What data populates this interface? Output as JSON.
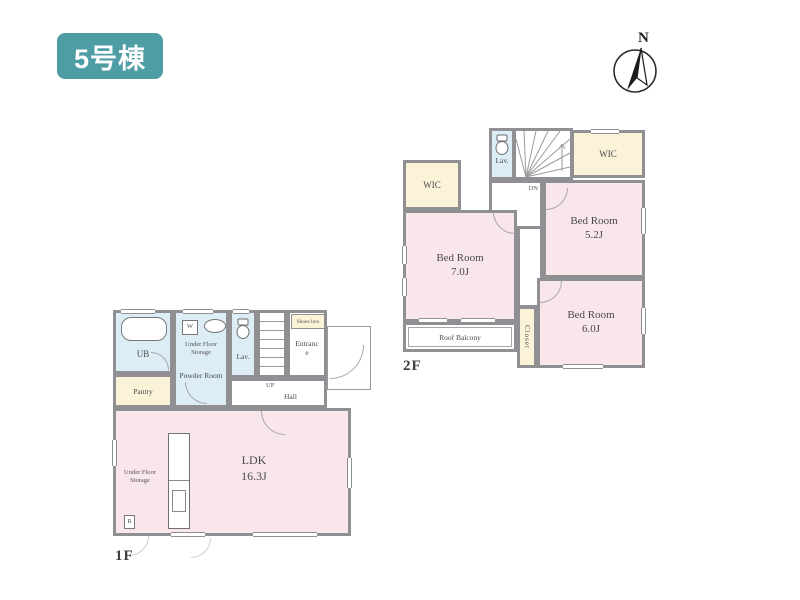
{
  "badge": {
    "label": "5号棟"
  },
  "compass": {
    "north_label": "N"
  },
  "colors": {
    "badge_teal": "#4E9CA4",
    "room_pink": "#F8E6EA",
    "room_blue": "#DCEDF5",
    "room_cream": "#FAF3D8",
    "wall_gray": "#8F8F94"
  },
  "floor1": {
    "floor_label": "1F",
    "rooms": {
      "ub": {
        "label": "UB"
      },
      "pantry": {
        "label": "Pantry"
      },
      "powder_room": {
        "label": "Powder Room"
      },
      "under_floor_storage_powder": {
        "label": "Under Floor Storage"
      },
      "washer": {
        "label": "W"
      },
      "lav": {
        "label": "Lav."
      },
      "stairs": {
        "label": "UP"
      },
      "hall": {
        "label": "Hall"
      },
      "shoes_box": {
        "label": "Shoes box"
      },
      "entrance": {
        "label": "Entrance"
      },
      "ldk": {
        "label": "LDK",
        "size": "16.3J"
      },
      "under_floor_storage_ldk": {
        "label": "Under Floor Storage"
      },
      "refrigerator": {
        "label": "R"
      }
    }
  },
  "floor2": {
    "floor_label": "2F",
    "rooms": {
      "wic_left": {
        "label": "WIC"
      },
      "wic_right": {
        "label": "WIC"
      },
      "lav": {
        "label": "Lav."
      },
      "stairs": {
        "label": "DN"
      },
      "hall": {
        "label": "Hall"
      },
      "bedroom_7": {
        "label": "Bed Room",
        "size": "7.0J"
      },
      "bedroom_5": {
        "label": "Bed Room",
        "size": "5.2J"
      },
      "bedroom_6": {
        "label": "Bed Room",
        "size": "6.0J"
      },
      "roof_balcony": {
        "label": "Roof Balcony"
      },
      "closet": {
        "label": "Closet"
      }
    }
  }
}
